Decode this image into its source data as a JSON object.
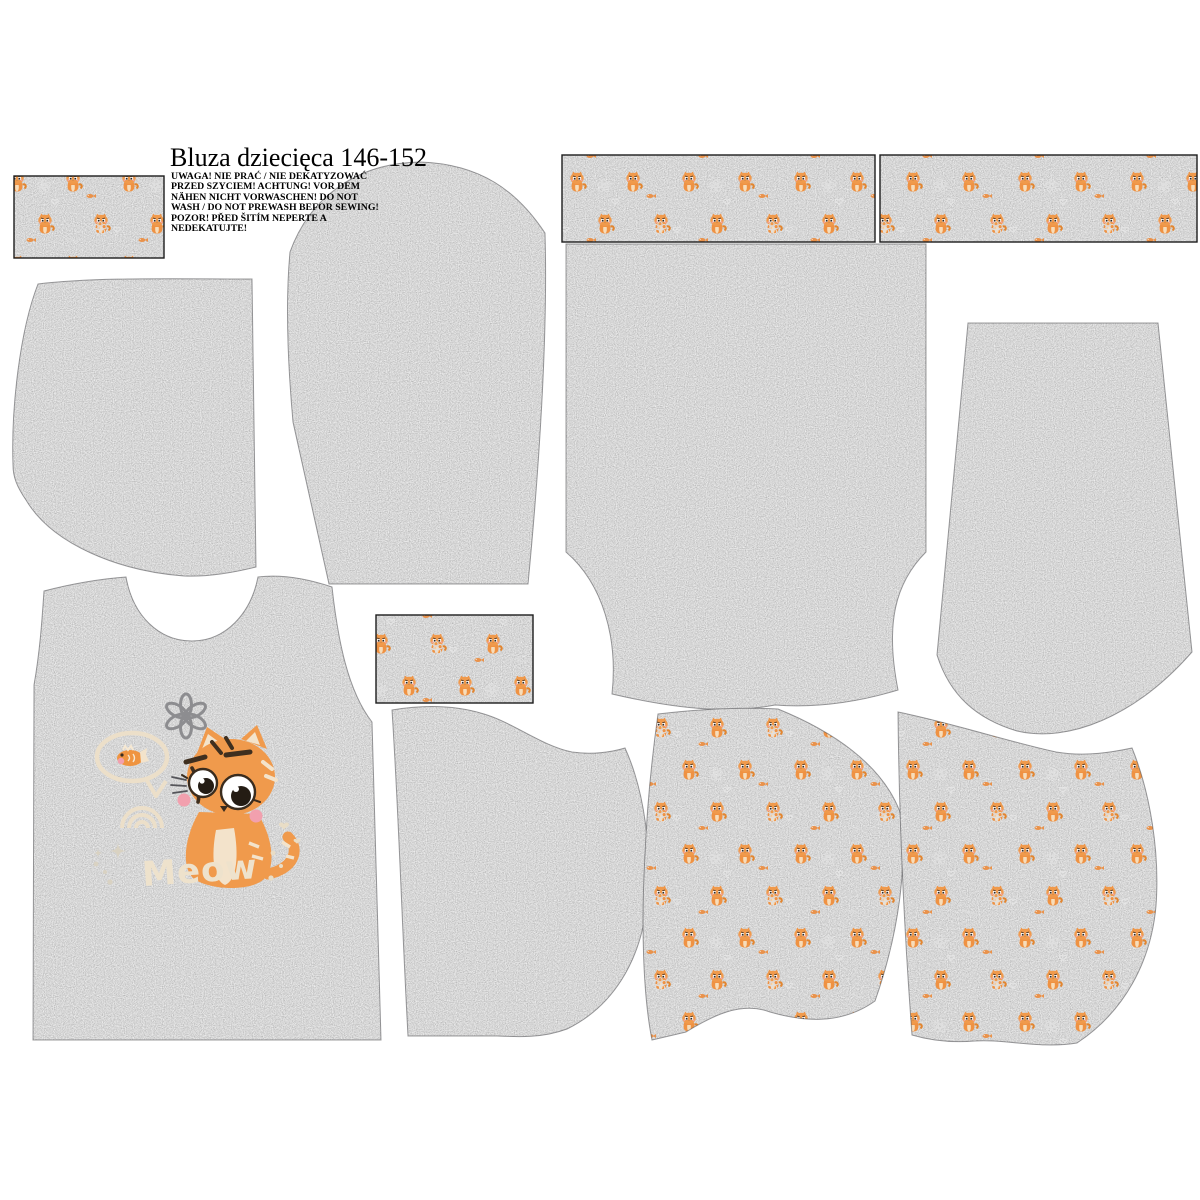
{
  "document": {
    "title": "Bluza dziecięca 146-152",
    "warning_lines": [
      "UWAGA! NIE PRAĆ / NIE DEKATYZOWAĆ",
      "PRZED SZYCIEM! ACHTUNG! VOR DEM",
      "NÄHEN NICHT VORWASCHEN! DO NOT",
      "WASH / DO NOT PREWASH BEFOR SEWING!",
      "POZOR! PŘED ŠITÍM NEPERTE A",
      "NEDEKATUJTE!"
    ]
  },
  "artwork": {
    "meow_text": "Meow"
  },
  "fabric": {
    "melange_gray": "#9e9ea0",
    "print_cat_orange": "#ef9243",
    "panel_cat_orange": "#f09a4c",
    "cream": "#eee2cc",
    "blush_pink": "#f2a0ae"
  }
}
